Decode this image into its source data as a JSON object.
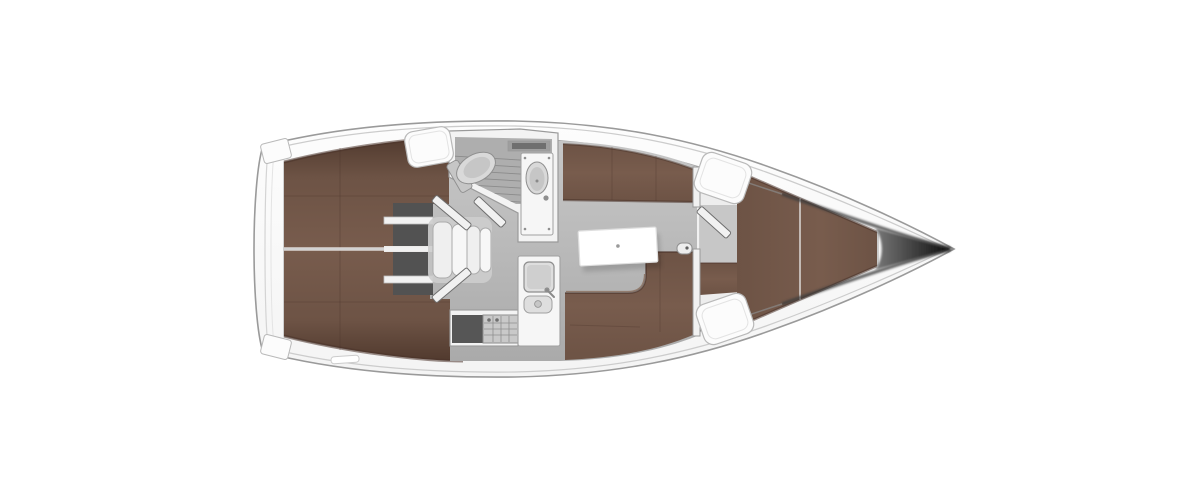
{
  "figure": {
    "kind": "yacht-interior-floor-plan",
    "orientation_bow": "right",
    "orientation_stern": "left"
  },
  "components": [
    "transom-swim-platform",
    "aft-cabin-port-berth",
    "aft-cabin-starboard-berth",
    "engine-compartment",
    "companionway-steps",
    "aft-cabin-door-port",
    "aft-cabin-door-starboard",
    "wet-head-with-shower",
    "toilet",
    "washbasin",
    "head-door",
    "galley-counter",
    "galley-sink",
    "galley-stove",
    "galley-oven",
    "salon-floor",
    "salon-table",
    "salon-settee-starboard",
    "salon-settee-port",
    "mast-post",
    "forward-bulkhead",
    "forward-cabin-door",
    "forward-cabin-floor",
    "forward-cabin-seat",
    "v-berth",
    "deck-hatch-companionway",
    "deck-hatch-forward-starboard",
    "deck-hatch-forward-port",
    "stern-step-starboard",
    "stern-step-port",
    "bow-tip"
  ],
  "colors": {
    "background": "#ffffff",
    "hull_fill": "#fdfdfd",
    "hull_fill_low": "#f4f4f4",
    "hull_outline": "#9a9a9a",
    "sheer_line": "#cccccc",
    "deck_edge": "#a8a8a8",
    "interior_fill": "#f1f1f1",
    "floor_light": "#c7c7c7",
    "floor_mid": "#b9b9b9",
    "floor_dark": "#aaaaaa",
    "berth_edge": "#513a2e",
    "berth_mid": "#6d5345",
    "berth_light": "#785c4d",
    "berth_seam": "#4a332a",
    "berth_highlight": "#8a6e5d",
    "divider_light": "#f0f0f0",
    "divider_core": "#9f9f9f",
    "locker_dark": "#525252",
    "shelf_bar": "#f2f2f2",
    "shelf_bar_stroke": "#bdbdbd",
    "step_fill": "#efefef",
    "step_fill_alt": "#f7f7f7",
    "step_stroke": "#ababab",
    "step_pad": "#cdcdcd",
    "door_fill": "#f1f1f1",
    "door_stroke": "#6e6e6e",
    "wall_fill": "#f3f3f3",
    "wall_stroke": "#9a9a9a",
    "shower_floor": "#aeaeae",
    "grate_line": "#8b8b8b",
    "shelf_slot": "#6f6f6f",
    "shelf_slot_frame": "#9e9e9e",
    "fixture_fill": "#d9d9d9",
    "fixture_inner": "#c6c6c6",
    "fixture_stroke": "#8f8f8f",
    "unit_fill": "#f6f6f6",
    "unit_stroke": "#a0a0a0",
    "sink_fill": "#dedede",
    "sink_inner": "#cfcfcf",
    "stove_fill": "#c9c9c9",
    "stove_stroke": "#8e8e8e",
    "inset_dark": "#565656",
    "knob": "#6f6f6f",
    "faucet": "#8a8a8a",
    "table_fill": "#ffffff",
    "table_stroke": "#dedede",
    "table_dot": "#9a9a9a",
    "hatch_fill": "#fcfcfc",
    "hatch_stroke": "#b9b9b9",
    "hatch_inner": "#e3e3e3",
    "post_fill": "#ededed",
    "post_dot": "#5f5f5f",
    "transom_line": "#d4d4d4",
    "transom_line2": "#e4e4e4",
    "bow_dark_start": "#787878",
    "bow_dark_end": "#0a0a0a",
    "bow_edge": "#3c3c3c",
    "bow_edge_soft": "#8a8a8a"
  }
}
